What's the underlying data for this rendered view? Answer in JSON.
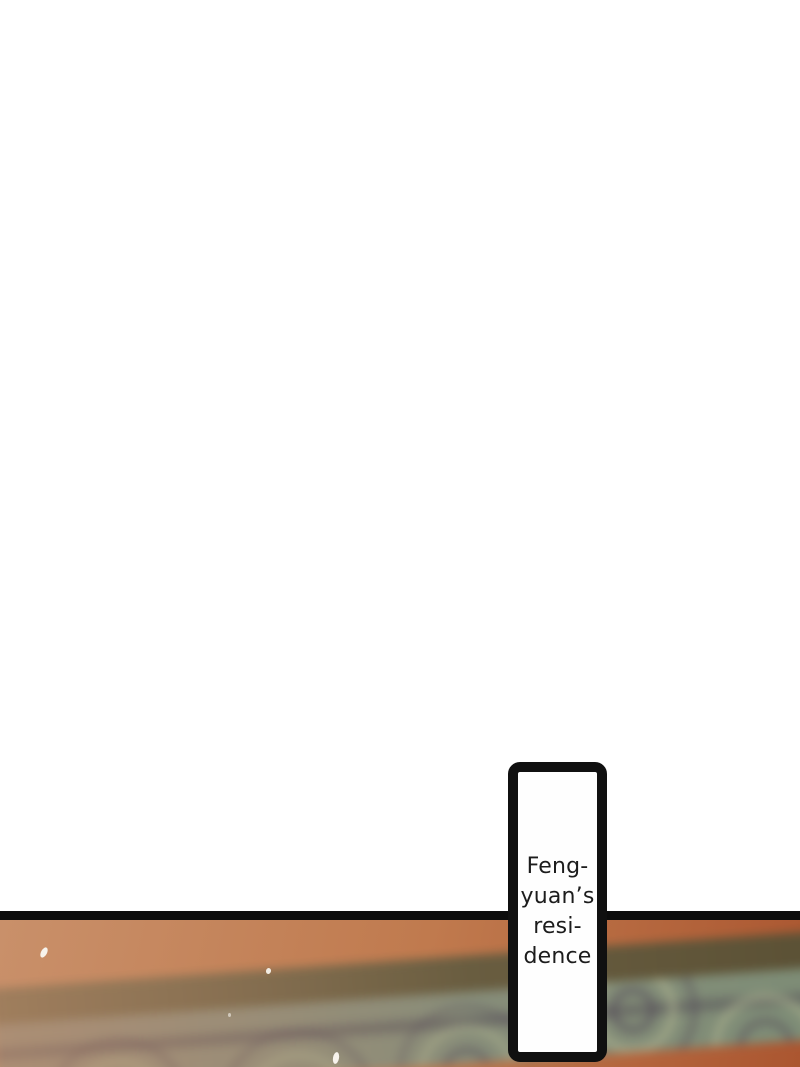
{
  "page": {
    "width_px": 800,
    "height_px": 1067
  },
  "colors": {
    "page-bg": "#ffffff",
    "divider": "#0c0c0c",
    "box-border": "#101010",
    "box-bg": "#fefefe",
    "text": "#1c1c1c",
    "orange-light": "#c9906a",
    "orange-mid": "#c07a4e",
    "orange-deep": "#ab5630",
    "beam-dark-left": "#7d6d4c",
    "beam-dark-right": "#5c5132",
    "beam-base-left": "#958d7b",
    "beam-base-right": "#7c8d74",
    "swirl-dark": "#4e4156",
    "swirl-light": "#adb28c",
    "petal": "#f7f3ec"
  },
  "label_box": {
    "lines": [
      "Feng-",
      "yuan’s",
      "resi-",
      "dence"
    ],
    "full_text": "Feng-yuan's residence"
  }
}
